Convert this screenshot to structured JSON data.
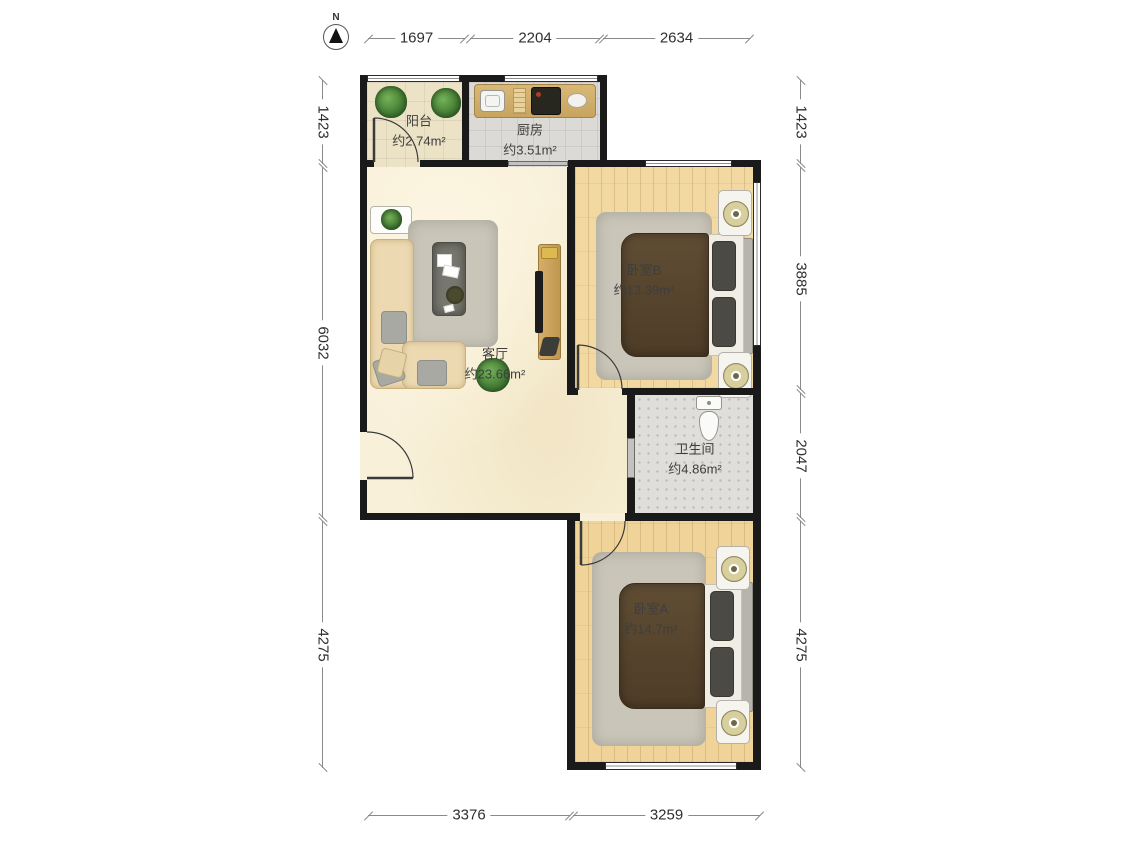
{
  "north": {
    "label": "N"
  },
  "rooms": {
    "balcony": {
      "name": "阳台",
      "area": "约2.74m²"
    },
    "kitchen": {
      "name": "厨房",
      "area": "约3.51m²"
    },
    "living": {
      "name": "客厅",
      "area": "约23.66m²"
    },
    "bedroom_b": {
      "name": "卧室B",
      "area": "约13.39m²"
    },
    "bathroom": {
      "name": "卫生间",
      "area": "约4.86m²"
    },
    "bedroom_a": {
      "name": "卧室A",
      "area": "约14.7m²"
    }
  },
  "dimensions_mm": {
    "top": [
      "1697",
      "2204",
      "2634"
    ],
    "left": [
      "1423",
      "6032",
      "4275"
    ],
    "right": [
      "1423",
      "3885",
      "2047",
      "4275"
    ],
    "bottom": [
      "3376",
      "3259"
    ]
  },
  "colors": {
    "wall": "#1a1a1a",
    "living_floor": "#f8f0d9",
    "wood_floor": "#f2d9a1",
    "tile_floor": "#dbdad6",
    "dimension_text": "#2f2f2f"
  }
}
